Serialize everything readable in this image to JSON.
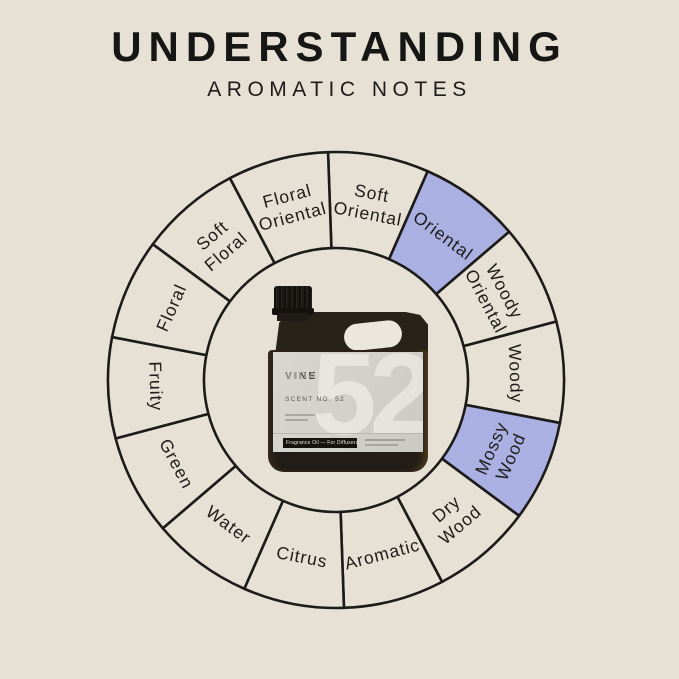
{
  "page": {
    "background": "#e7e0d4"
  },
  "header": {
    "title": "UNDERSTANDING",
    "subtitle": "AROMATIC NOTES"
  },
  "wheel": {
    "stroke_color": "#1c1b19",
    "segment_fill": "#e7e0d4",
    "highlight_fill": "#abb0e3",
    "label_color": "#1d1c1a",
    "cx": 336,
    "cy": 380,
    "outer_r": 228,
    "inner_r": 132,
    "label_r": 180,
    "start_deg": -2,
    "segments": [
      {
        "label": "Soft Oriental",
        "lines": [
          "Soft",
          "Oriental"
        ],
        "highlighted": false
      },
      {
        "label": "Oriental",
        "lines": [
          "Oriental"
        ],
        "highlighted": true
      },
      {
        "label": "Woody Oriental",
        "lines": [
          "Woody",
          "Oriental"
        ],
        "highlighted": false
      },
      {
        "label": "Woody",
        "lines": [
          "Woody"
        ],
        "highlighted": false
      },
      {
        "label": "Mossy Wood",
        "lines": [
          "Mossy",
          "Wood"
        ],
        "highlighted": true
      },
      {
        "label": "Dry Wood",
        "lines": [
          "Dry",
          "Wood"
        ],
        "highlighted": false
      },
      {
        "label": "Aromatic",
        "lines": [
          "Aromatic"
        ],
        "highlighted": false
      },
      {
        "label": "Citrus",
        "lines": [
          "Citrus"
        ],
        "highlighted": false
      },
      {
        "label": "Water",
        "lines": [
          "Water"
        ],
        "highlighted": false
      },
      {
        "label": "Green",
        "lines": [
          "Green"
        ],
        "highlighted": false
      },
      {
        "label": "Fruity",
        "lines": [
          "Fruity"
        ],
        "highlighted": false
      },
      {
        "label": "Floral",
        "lines": [
          "Floral"
        ],
        "highlighted": false
      },
      {
        "label": "Soft Floral",
        "lines": [
          "Soft",
          "Floral"
        ],
        "highlighted": false
      },
      {
        "label": "Floral Oriental",
        "lines": [
          "Floral",
          "Oriental"
        ],
        "highlighted": false
      }
    ]
  },
  "bottle": {
    "brand_bold": "VINE",
    "brand_light": "VIDA",
    "scent_line": "SCENT NO. 52",
    "watermark": "52",
    "badge": "Fragrance Oil — For Diffusers"
  }
}
